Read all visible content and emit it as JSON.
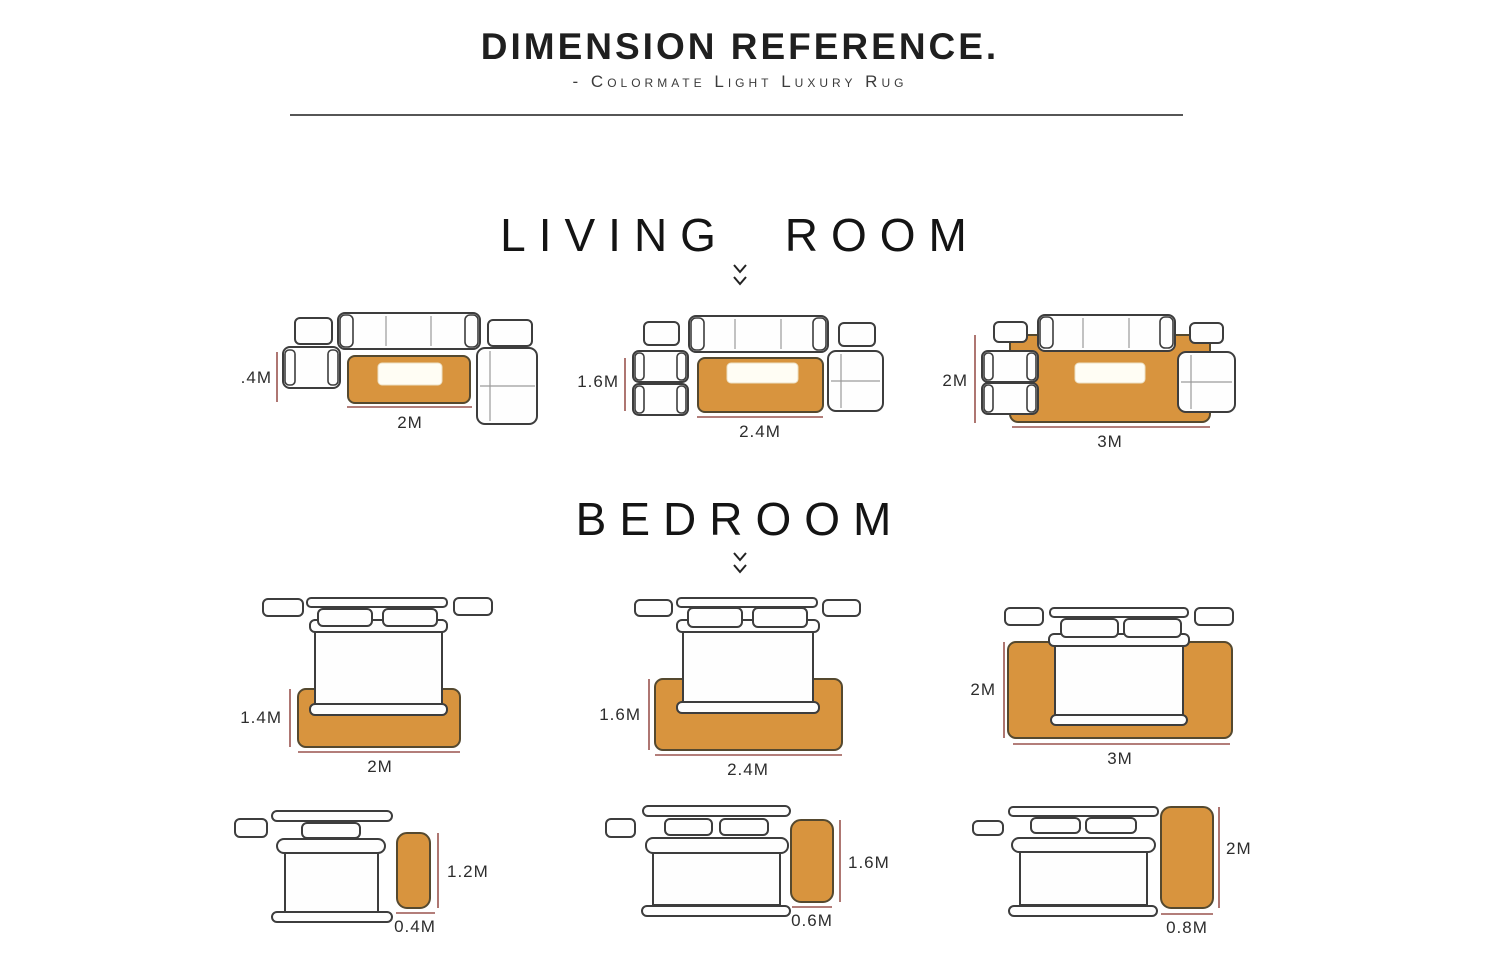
{
  "header": {
    "title": "DIMENSION REFERENCE.",
    "subtitle": "- Colormate Light Luxury Rug"
  },
  "living": {
    "heading": "LIVING ROOM",
    "layouts": [
      {
        "rug_height": ".4M",
        "rug_width": "2M"
      },
      {
        "rug_height": "1.6M",
        "rug_width": "2.4M"
      },
      {
        "rug_height": "2M",
        "rug_width": "3M"
      }
    ]
  },
  "bedroom": {
    "heading": "BEDROOM",
    "bed_layouts": [
      {
        "rug_height": "1.4M",
        "rug_width": "2M"
      },
      {
        "rug_height": "1.6M",
        "rug_width": "2.4M"
      },
      {
        "rug_height": "2M",
        "rug_width": "3M"
      }
    ],
    "runner_layouts": [
      {
        "rug_height": "1.2M",
        "rug_width": "0.4M"
      },
      {
        "rug_height": "1.6M",
        "rug_width": "0.6M"
      },
      {
        "rug_height": "2M",
        "rug_width": "0.8M"
      }
    ]
  },
  "colors": {
    "rug": "#d8943e",
    "dimension_line": "#9a544e",
    "furniture_outline": "#3d3d3d"
  }
}
